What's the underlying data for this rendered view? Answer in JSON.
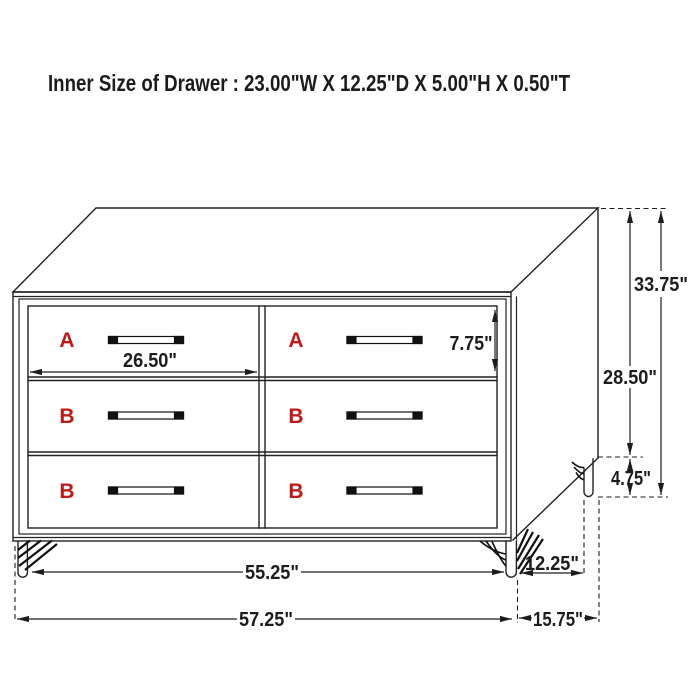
{
  "title": "Inner Size of Drawer : 23.00\"W X 12.25\"D X 5.00\"H X 0.50\"T",
  "colors": {
    "line": "#222222",
    "drawer_letter_red": "#c01818",
    "background": "#ffffff"
  },
  "diagram": {
    "type": "furniture-dimension-drawing",
    "item": "six-drawer dresser, three-quarter perspective view",
    "drawer_labels": [
      "A",
      "A",
      "B",
      "B",
      "B",
      "B"
    ],
    "dimensions": {
      "overall_height": "33.75\"",
      "cabinet_height": "28.50\"",
      "leg_height": "4.75\"",
      "drawer_front_height": "7.75\"",
      "drawer_front_width": "26.50\"",
      "leg_span_width": "55.25\"",
      "overall_width": "57.25\"",
      "top_depth": "12.25\"",
      "overall_depth": "15.75\""
    }
  }
}
